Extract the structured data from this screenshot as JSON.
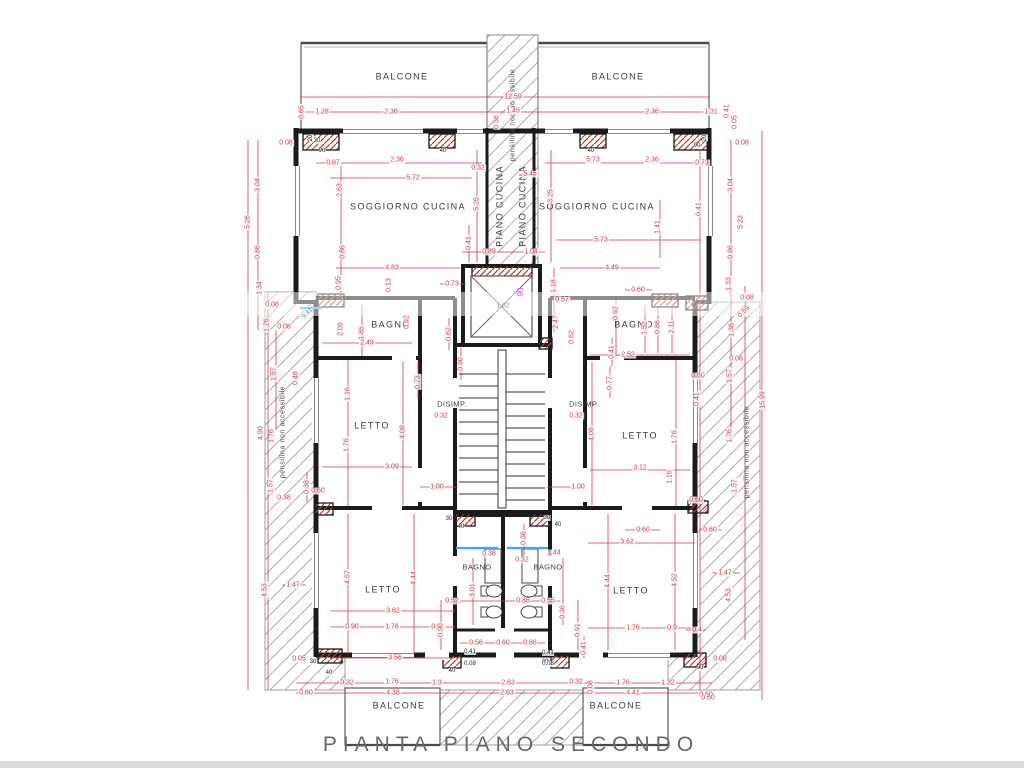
{
  "title": "PIANTA  PIANO  SECONDO",
  "colors": {
    "wall_black": "#1b1b1b",
    "dimension_red": "#d6374f",
    "hatch_gray": "#adadad",
    "pillar_hatch_red": "#c0392b",
    "glass_blue": "#3fa9f5",
    "elevator_magenta": "#e23bd4",
    "title_gray": "#63686d"
  },
  "labels": [
    {
      "t": "BALCONE",
      "x": 402,
      "y": 77,
      "c": "room"
    },
    {
      "t": "BALCONE",
      "x": 618,
      "y": 77,
      "c": "room"
    },
    {
      "t": "SOGGIORNO CUCINA",
      "x": 408,
      "y": 207,
      "c": "room"
    },
    {
      "t": "SOGGIORNO CUCINA",
      "x": 597,
      "y": 207,
      "c": "room"
    },
    {
      "t": "PIANO CUCINA",
      "x": 500,
      "y": 206,
      "r": -90,
      "c": "room"
    },
    {
      "t": "PIANO CUCINA",
      "x": 523,
      "y": 206,
      "r": -90,
      "c": "room"
    },
    {
      "t": "BAGNO",
      "x": 391,
      "y": 325,
      "c": "room"
    },
    {
      "t": "BAGNO",
      "x": 634,
      "y": 325,
      "c": "room"
    },
    {
      "t": "LETTO",
      "x": 372,
      "y": 426,
      "c": "room"
    },
    {
      "t": "LETTO",
      "x": 640,
      "y": 436,
      "c": "room"
    },
    {
      "t": "DISIMP.",
      "x": 452,
      "y": 404,
      "c": "small"
    },
    {
      "t": "DISIMP.",
      "x": 584,
      "y": 404,
      "c": "small"
    },
    {
      "t": "LETTO",
      "x": 383,
      "y": 590,
      "c": "room"
    },
    {
      "t": "LETTO",
      "x": 631,
      "y": 591,
      "c": "room"
    },
    {
      "t": "BAGNO",
      "x": 477,
      "y": 567,
      "c": "small"
    },
    {
      "t": "BAGNO",
      "x": 548,
      "y": 567,
      "c": "small"
    },
    {
      "t": "BALCONE",
      "x": 399,
      "y": 706,
      "c": "room"
    },
    {
      "t": "BALCONE",
      "x": 616,
      "y": 706,
      "c": "room"
    },
    {
      "t": "pensilina non accessibile",
      "x": 513,
      "y": 115,
      "r": -90,
      "c": "pens"
    },
    {
      "t": "pensilina non accessibile",
      "x": 283,
      "y": 432,
      "r": -90,
      "c": "pens"
    },
    {
      "t": "pensilina non accessibile",
      "x": 747,
      "y": 452,
      "r": -90,
      "c": "pens"
    },
    {
      "t": "12.59",
      "x": 513,
      "y": 97,
      "c": "dim"
    },
    {
      "t": "1.28",
      "x": 322,
      "y": 112,
      "c": "dim"
    },
    {
      "t": "2.36",
      "x": 391,
      "y": 112,
      "c": "dim"
    },
    {
      "t": "1.45",
      "x": 513,
      "y": 111,
      "c": "dim"
    },
    {
      "t": "2.36",
      "x": 652,
      "y": 112,
      "c": "dim"
    },
    {
      "t": "1.31",
      "x": 711,
      "y": 112,
      "c": "dim"
    },
    {
      "t": "0.65",
      "x": 302,
      "y": 112,
      "r": -90,
      "c": "dim"
    },
    {
      "t": "0.41",
      "x": 727,
      "y": 111,
      "r": -90,
      "c": "dim"
    },
    {
      "t": "0.05",
      "x": 735,
      "y": 122,
      "r": -90,
      "c": "dim"
    },
    {
      "t": "0.08",
      "x": 286,
      "y": 143,
      "c": "dim"
    },
    {
      "t": "0.08",
      "x": 742,
      "y": 143,
      "c": "dim"
    },
    {
      "t": "0.38",
      "x": 497,
      "y": 122,
      "r": -90,
      "c": "dim"
    },
    {
      "t": "0.87",
      "x": 333,
      "y": 163,
      "c": "dim"
    },
    {
      "t": "2.36",
      "x": 397,
      "y": 160,
      "c": "dim"
    },
    {
      "t": "0.32",
      "x": 478,
      "y": 168,
      "c": "dim"
    },
    {
      "t": "5.45",
      "x": 530,
      "y": 174,
      "c": "dim"
    },
    {
      "t": "5.73",
      "x": 593,
      "y": 160,
      "c": "dim"
    },
    {
      "t": "2.36",
      "x": 652,
      "y": 160,
      "c": "dim"
    },
    {
      "t": "0.73",
      "x": 702,
      "y": 163,
      "c": "dim"
    },
    {
      "t": "5.72",
      "x": 413,
      "y": 178,
      "c": "dim"
    },
    {
      "t": "2.63",
      "x": 340,
      "y": 190,
      "r": -90,
      "c": "dim"
    },
    {
      "t": "3.04",
      "x": 258,
      "y": 185,
      "r": -90,
      "c": "dim"
    },
    {
      "t": "5.26",
      "x": 248,
      "y": 222,
      "r": -90,
      "c": "dim"
    },
    {
      "t": "0.86",
      "x": 258,
      "y": 252,
      "r": -90,
      "c": "dim"
    },
    {
      "t": "1.34",
      "x": 260,
      "y": 288,
      "r": -90,
      "c": "dim"
    },
    {
      "t": "1.26",
      "x": 267,
      "y": 325,
      "r": -90,
      "c": "dim"
    },
    {
      "t": "0.08",
      "x": 272,
      "y": 305,
      "c": "dim"
    },
    {
      "t": "0.08",
      "x": 284,
      "y": 327,
      "c": "dim"
    },
    {
      "t": "1.57",
      "x": 274,
      "y": 374,
      "r": -90,
      "c": "dim"
    },
    {
      "t": "0.48",
      "x": 296,
      "y": 378,
      "r": -90,
      "c": "dim"
    },
    {
      "t": "5.25",
      "x": 477,
      "y": 204,
      "r": -90,
      "c": "dim"
    },
    {
      "t": "3.25",
      "x": 551,
      "y": 196,
      "r": -90,
      "c": "dim"
    },
    {
      "t": "0.41",
      "x": 469,
      "y": 243,
      "r": -90,
      "c": "dim"
    },
    {
      "t": "0.89",
      "x": 489,
      "y": 252,
      "c": "dim"
    },
    {
      "t": "1.04",
      "x": 531,
      "y": 252,
      "c": "dim"
    },
    {
      "t": "4.83",
      "x": 392,
      "y": 268,
      "c": "dim"
    },
    {
      "t": "5.73",
      "x": 601,
      "y": 240,
      "c": "dim"
    },
    {
      "t": "4.49",
      "x": 612,
      "y": 268,
      "c": "dim"
    },
    {
      "t": "0.41",
      "x": 699,
      "y": 209,
      "r": -90,
      "c": "dim"
    },
    {
      "t": "1.41",
      "x": 658,
      "y": 227,
      "r": -90,
      "c": "dim"
    },
    {
      "t": "3.04",
      "x": 731,
      "y": 185,
      "r": -90,
      "c": "dim"
    },
    {
      "t": "5.23",
      "x": 741,
      "y": 222,
      "r": -90,
      "c": "dim"
    },
    {
      "t": "0.86",
      "x": 731,
      "y": 252,
      "r": -90,
      "c": "dim"
    },
    {
      "t": "1.33",
      "x": 729,
      "y": 284,
      "r": -90,
      "c": "dim"
    },
    {
      "t": "0.86",
      "x": 343,
      "y": 252,
      "r": -90,
      "c": "dim"
    },
    {
      "t": "0.95",
      "x": 339,
      "y": 283,
      "r": -90,
      "c": "dim"
    },
    {
      "t": "0.13",
      "x": 389,
      "y": 285,
      "r": -90,
      "c": "dim"
    },
    {
      "t": "0.73",
      "x": 452,
      "y": 284,
      "c": "dim"
    },
    {
      "t": "1.18",
      "x": 554,
      "y": 286,
      "r": -90,
      "c": "dim"
    },
    {
      "t": "0.57",
      "x": 562,
      "y": 300,
      "c": "dim"
    },
    {
      "t": "2.47",
      "x": 556,
      "y": 322,
      "r": -90,
      "c": "dim"
    },
    {
      "t": "0.62",
      "x": 449,
      "y": 334,
      "r": -90,
      "c": "dim"
    },
    {
      "t": "0.62",
      "x": 572,
      "y": 337,
      "r": -90,
      "c": "dim"
    },
    {
      "t": "2.09",
      "x": 341,
      "y": 329,
      "r": -90,
      "c": "dim"
    },
    {
      "t": "1.85",
      "x": 362,
      "y": 333,
      "r": -90,
      "c": "dim"
    },
    {
      "t": "2.49",
      "x": 367,
      "y": 343,
      "c": "dim"
    },
    {
      "t": "0.92",
      "x": 407,
      "y": 322,
      "r": -90,
      "c": "dim"
    },
    {
      "t": "0.92",
      "x": 616,
      "y": 313,
      "r": -90,
      "c": "dim"
    },
    {
      "t": "1.52",
      "x": 645,
      "y": 328,
      "r": -90,
      "c": "dim"
    },
    {
      "t": "0.86",
      "x": 658,
      "y": 327,
      "r": -90,
      "c": "dim"
    },
    {
      "t": "2.11",
      "x": 672,
      "y": 327,
      "r": -90,
      "c": "dim"
    },
    {
      "t": "2.52",
      "x": 628,
      "y": 355,
      "c": "dim"
    },
    {
      "t": "0.60",
      "x": 638,
      "y": 290,
      "c": "dim"
    },
    {
      "t": "0.41",
      "x": 612,
      "y": 352,
      "r": -90,
      "c": "dim"
    },
    {
      "t": "0.08",
      "x": 747,
      "y": 298,
      "c": "dim"
    },
    {
      "t": "0.59",
      "x": 744,
      "y": 312,
      "r": -45,
      "c": "dim"
    },
    {
      "t": "1.38",
      "x": 732,
      "y": 330,
      "r": -90,
      "c": "dim"
    },
    {
      "t": "0.08",
      "x": 736,
      "y": 359,
      "c": "dim"
    },
    {
      "t": "1.57",
      "x": 730,
      "y": 376,
      "r": -90,
      "c": "dim"
    },
    {
      "t": "0.60",
      "x": 698,
      "y": 376,
      "c": "dim"
    },
    {
      "t": "0.41",
      "x": 697,
      "y": 399,
      "r": -90,
      "c": "dim"
    },
    {
      "t": "15.99",
      "x": 763,
      "y": 400,
      "r": -90,
      "c": "dim"
    },
    {
      "t": "1.16",
      "x": 348,
      "y": 394,
      "r": -90,
      "c": "dim"
    },
    {
      "t": "1.76",
      "x": 347,
      "y": 445,
      "r": -90,
      "c": "dim"
    },
    {
      "t": "4.08",
      "x": 403,
      "y": 432,
      "r": -90,
      "c": "dim"
    },
    {
      "t": "0.73",
      "x": 418,
      "y": 382,
      "r": -90,
      "c": "dim"
    },
    {
      "t": "3.09",
      "x": 392,
      "y": 467,
      "c": "dim"
    },
    {
      "t": "0.32",
      "x": 441,
      "y": 416,
      "c": "dim"
    },
    {
      "t": "0.90",
      "x": 461,
      "y": 364,
      "r": -90,
      "c": "dim"
    },
    {
      "t": "1.00",
      "x": 437,
      "y": 487,
      "c": "dim"
    },
    {
      "t": "0.38",
      "x": 307,
      "y": 487,
      "r": -90,
      "c": "dim"
    },
    {
      "t": "0.60",
      "x": 318,
      "y": 491,
      "c": "dim"
    },
    {
      "t": "0.38",
      "x": 284,
      "y": 498,
      "c": "dim"
    },
    {
      "t": "4.90",
      "x": 261,
      "y": 433,
      "r": -90,
      "c": "dim"
    },
    {
      "t": "1.76",
      "x": 272,
      "y": 436,
      "r": -90,
      "c": "dim"
    },
    {
      "t": "1.57",
      "x": 271,
      "y": 486,
      "r": -90,
      "c": "dim"
    },
    {
      "t": "4.53",
      "x": 265,
      "y": 590,
      "r": -90,
      "c": "dim"
    },
    {
      "t": "1.47",
      "x": 293,
      "y": 585,
      "c": "dim"
    },
    {
      "t": "0.05",
      "x": 299,
      "y": 659,
      "c": "dim"
    },
    {
      "t": "0.60",
      "x": 306,
      "y": 693,
      "c": "dim"
    },
    {
      "t": "0.32",
      "x": 576,
      "y": 416,
      "c": "dim"
    },
    {
      "t": "0.77",
      "x": 610,
      "y": 383,
      "r": -90,
      "c": "dim"
    },
    {
      "t": "1.00",
      "x": 578,
      "y": 487,
      "c": "dim"
    },
    {
      "t": "4.08",
      "x": 592,
      "y": 434,
      "r": -90,
      "c": "dim"
    },
    {
      "t": "1.76",
      "x": 675,
      "y": 437,
      "r": -90,
      "c": "dim"
    },
    {
      "t": "1.16",
      "x": 670,
      "y": 477,
      "r": -90,
      "c": "dim"
    },
    {
      "t": "3.12",
      "x": 640,
      "y": 468,
      "c": "dim"
    },
    {
      "t": "1.76",
      "x": 730,
      "y": 436,
      "r": -90,
      "c": "dim"
    },
    {
      "t": "1.57",
      "x": 735,
      "y": 486,
      "r": -90,
      "c": "dim"
    },
    {
      "t": "0.60",
      "x": 696,
      "y": 500,
      "c": "dim"
    },
    {
      "t": "0.60",
      "x": 710,
      "y": 530,
      "c": "dim"
    },
    {
      "t": "1.47",
      "x": 725,
      "y": 573,
      "c": "dim"
    },
    {
      "t": "4.53",
      "x": 729,
      "y": 595,
      "r": -90,
      "c": "dim"
    },
    {
      "t": "0.4",
      "x": 697,
      "y": 630,
      "c": "dim"
    },
    {
      "t": "0.08",
      "x": 720,
      "y": 659,
      "c": "dim"
    },
    {
      "t": "0.60",
      "x": 706,
      "y": 695,
      "c": "dim"
    },
    {
      "t": "4.57",
      "x": 348,
      "y": 577,
      "r": -90,
      "c": "dim"
    },
    {
      "t": "4.44",
      "x": 414,
      "y": 578,
      "r": -90,
      "c": "dim"
    },
    {
      "t": "3.62",
      "x": 393,
      "y": 611,
      "c": "dim"
    },
    {
      "t": "0.90",
      "x": 352,
      "y": 627,
      "c": "dim"
    },
    {
      "t": "1.76",
      "x": 392,
      "y": 627,
      "c": "dim"
    },
    {
      "t": "0.98",
      "x": 438,
      "y": 627,
      "c": "dim"
    },
    {
      "t": "3.56",
      "x": 395,
      "y": 658,
      "c": "dim"
    },
    {
      "t": "0.38",
      "x": 489,
      "y": 554,
      "c": "dim"
    },
    {
      "t": "0.36",
      "x": 524,
      "y": 538,
      "r": -90,
      "c": "dim"
    },
    {
      "t": "1.44",
      "x": 554,
      "y": 553,
      "c": "dim"
    },
    {
      "t": "0.32",
      "x": 522,
      "y": 560,
      "c": "dim"
    },
    {
      "t": "3.01",
      "x": 473,
      "y": 590,
      "r": -90,
      "c": "dim"
    },
    {
      "t": "0.36",
      "x": 563,
      "y": 612,
      "r": -90,
      "c": "dim"
    },
    {
      "t": "0.52",
      "x": 452,
      "y": 601,
      "c": "dim"
    },
    {
      "t": "0.86",
      "x": 523,
      "y": 601,
      "c": "dim"
    },
    {
      "t": "0.55",
      "x": 548,
      "y": 601,
      "c": "dim"
    },
    {
      "t": "0.56",
      "x": 476,
      "y": 643,
      "c": "dim"
    },
    {
      "t": "0.60",
      "x": 503,
      "y": 643,
      "c": "dim"
    },
    {
      "t": "0.86",
      "x": 530,
      "y": 643,
      "c": "dim"
    },
    {
      "t": "0.90",
      "x": 441,
      "y": 630,
      "r": -90,
      "c": "dim"
    },
    {
      "t": "0.91",
      "x": 578,
      "y": 630,
      "r": -90,
      "c": "dim"
    },
    {
      "t": "0.41",
      "x": 584,
      "y": 648,
      "r": -90,
      "c": "dim"
    },
    {
      "t": "3.62",
      "x": 627,
      "y": 542,
      "c": "dim"
    },
    {
      "t": "0.60",
      "x": 643,
      "y": 530,
      "c": "dim"
    },
    {
      "t": "4.44",
      "x": 608,
      "y": 581,
      "r": -90,
      "c": "dim"
    },
    {
      "t": "4.52",
      "x": 675,
      "y": 580,
      "r": -90,
      "c": "dim"
    },
    {
      "t": "1.76",
      "x": 633,
      "y": 628,
      "c": "dim"
    },
    {
      "t": "0.9",
      "x": 672,
      "y": 628,
      "c": "dim"
    },
    {
      "t": "0.32",
      "x": 347,
      "y": 683,
      "c": "dim"
    },
    {
      "t": "1.76",
      "x": 392,
      "y": 682,
      "c": "dim"
    },
    {
      "t": "1.3",
      "x": 437,
      "y": 683,
      "c": "dim"
    },
    {
      "t": "2.63",
      "x": 508,
      "y": 683,
      "c": "dim"
    },
    {
      "t": "0.32",
      "x": 576,
      "y": 682,
      "c": "dim"
    },
    {
      "t": "1.76",
      "x": 623,
      "y": 683,
      "c": "dim"
    },
    {
      "t": "1.32",
      "x": 668,
      "y": 683,
      "c": "dim"
    },
    {
      "t": "4.38",
      "x": 393,
      "y": 693,
      "c": "dim"
    },
    {
      "t": "2.63",
      "x": 507,
      "y": 693,
      "c": "dim"
    },
    {
      "t": "4.41",
      "x": 633,
      "y": 693,
      "c": "dim"
    },
    {
      "t": "0.60",
      "x": 708,
      "y": 698,
      "c": "dim"
    },
    {
      "t": "0.08",
      "x": 591,
      "y": 687,
      "r": -90,
      "c": "dim"
    },
    {
      "t": "9.41",
      "x": 308,
      "y": 314,
      "r": -45,
      "c": "blue"
    },
    {
      "t": "90",
      "x": 521,
      "y": 292,
      "r": -90,
      "c": "magenta"
    },
    {
      "t": "1.62",
      "x": 503,
      "y": 306,
      "c": "gray"
    },
    {
      "t": "30",
      "x": 317,
      "y": 141,
      "c": "tick"
    },
    {
      "t": "90",
      "x": 322,
      "y": 151,
      "c": "tick"
    },
    {
      "t": "40",
      "x": 443,
      "y": 151,
      "c": "tick"
    },
    {
      "t": "40",
      "x": 591,
      "y": 151,
      "c": "tick"
    },
    {
      "t": "90",
      "x": 697,
      "y": 146,
      "c": "tick"
    },
    {
      "t": "20",
      "x": 311,
      "y": 138,
      "r": -90,
      "c": "tick"
    },
    {
      "t": "20",
      "x": 705,
      "y": 138,
      "r": -90,
      "c": "tick"
    },
    {
      "t": "30",
      "x": 449,
      "y": 519,
      "c": "tick"
    },
    {
      "t": "40",
      "x": 461,
      "y": 527,
      "c": "tick"
    },
    {
      "t": "30",
      "x": 547,
      "y": 518,
      "c": "tick"
    },
    {
      "t": "40",
      "x": 558,
      "y": 525,
      "c": "tick"
    },
    {
      "t": "30",
      "x": 313,
      "y": 662,
      "c": "tick"
    },
    {
      "t": "40",
      "x": 329,
      "y": 673,
      "c": "tick"
    },
    {
      "t": "40",
      "x": 452,
      "y": 671,
      "c": "tick"
    },
    {
      "t": "30",
      "x": 545,
      "y": 662,
      "c": "tick"
    },
    {
      "t": "90",
      "x": 700,
      "y": 668,
      "c": "tick"
    },
    {
      "t": "0.41",
      "x": 548,
      "y": 653,
      "c": "tick"
    },
    {
      "t": "0.08",
      "x": 548,
      "y": 664,
      "c": "tick"
    },
    {
      "t": "0.41",
      "x": 470,
      "y": 652,
      "c": "tick"
    },
    {
      "t": "0.08",
      "x": 470,
      "y": 664,
      "c": "tick"
    }
  ]
}
